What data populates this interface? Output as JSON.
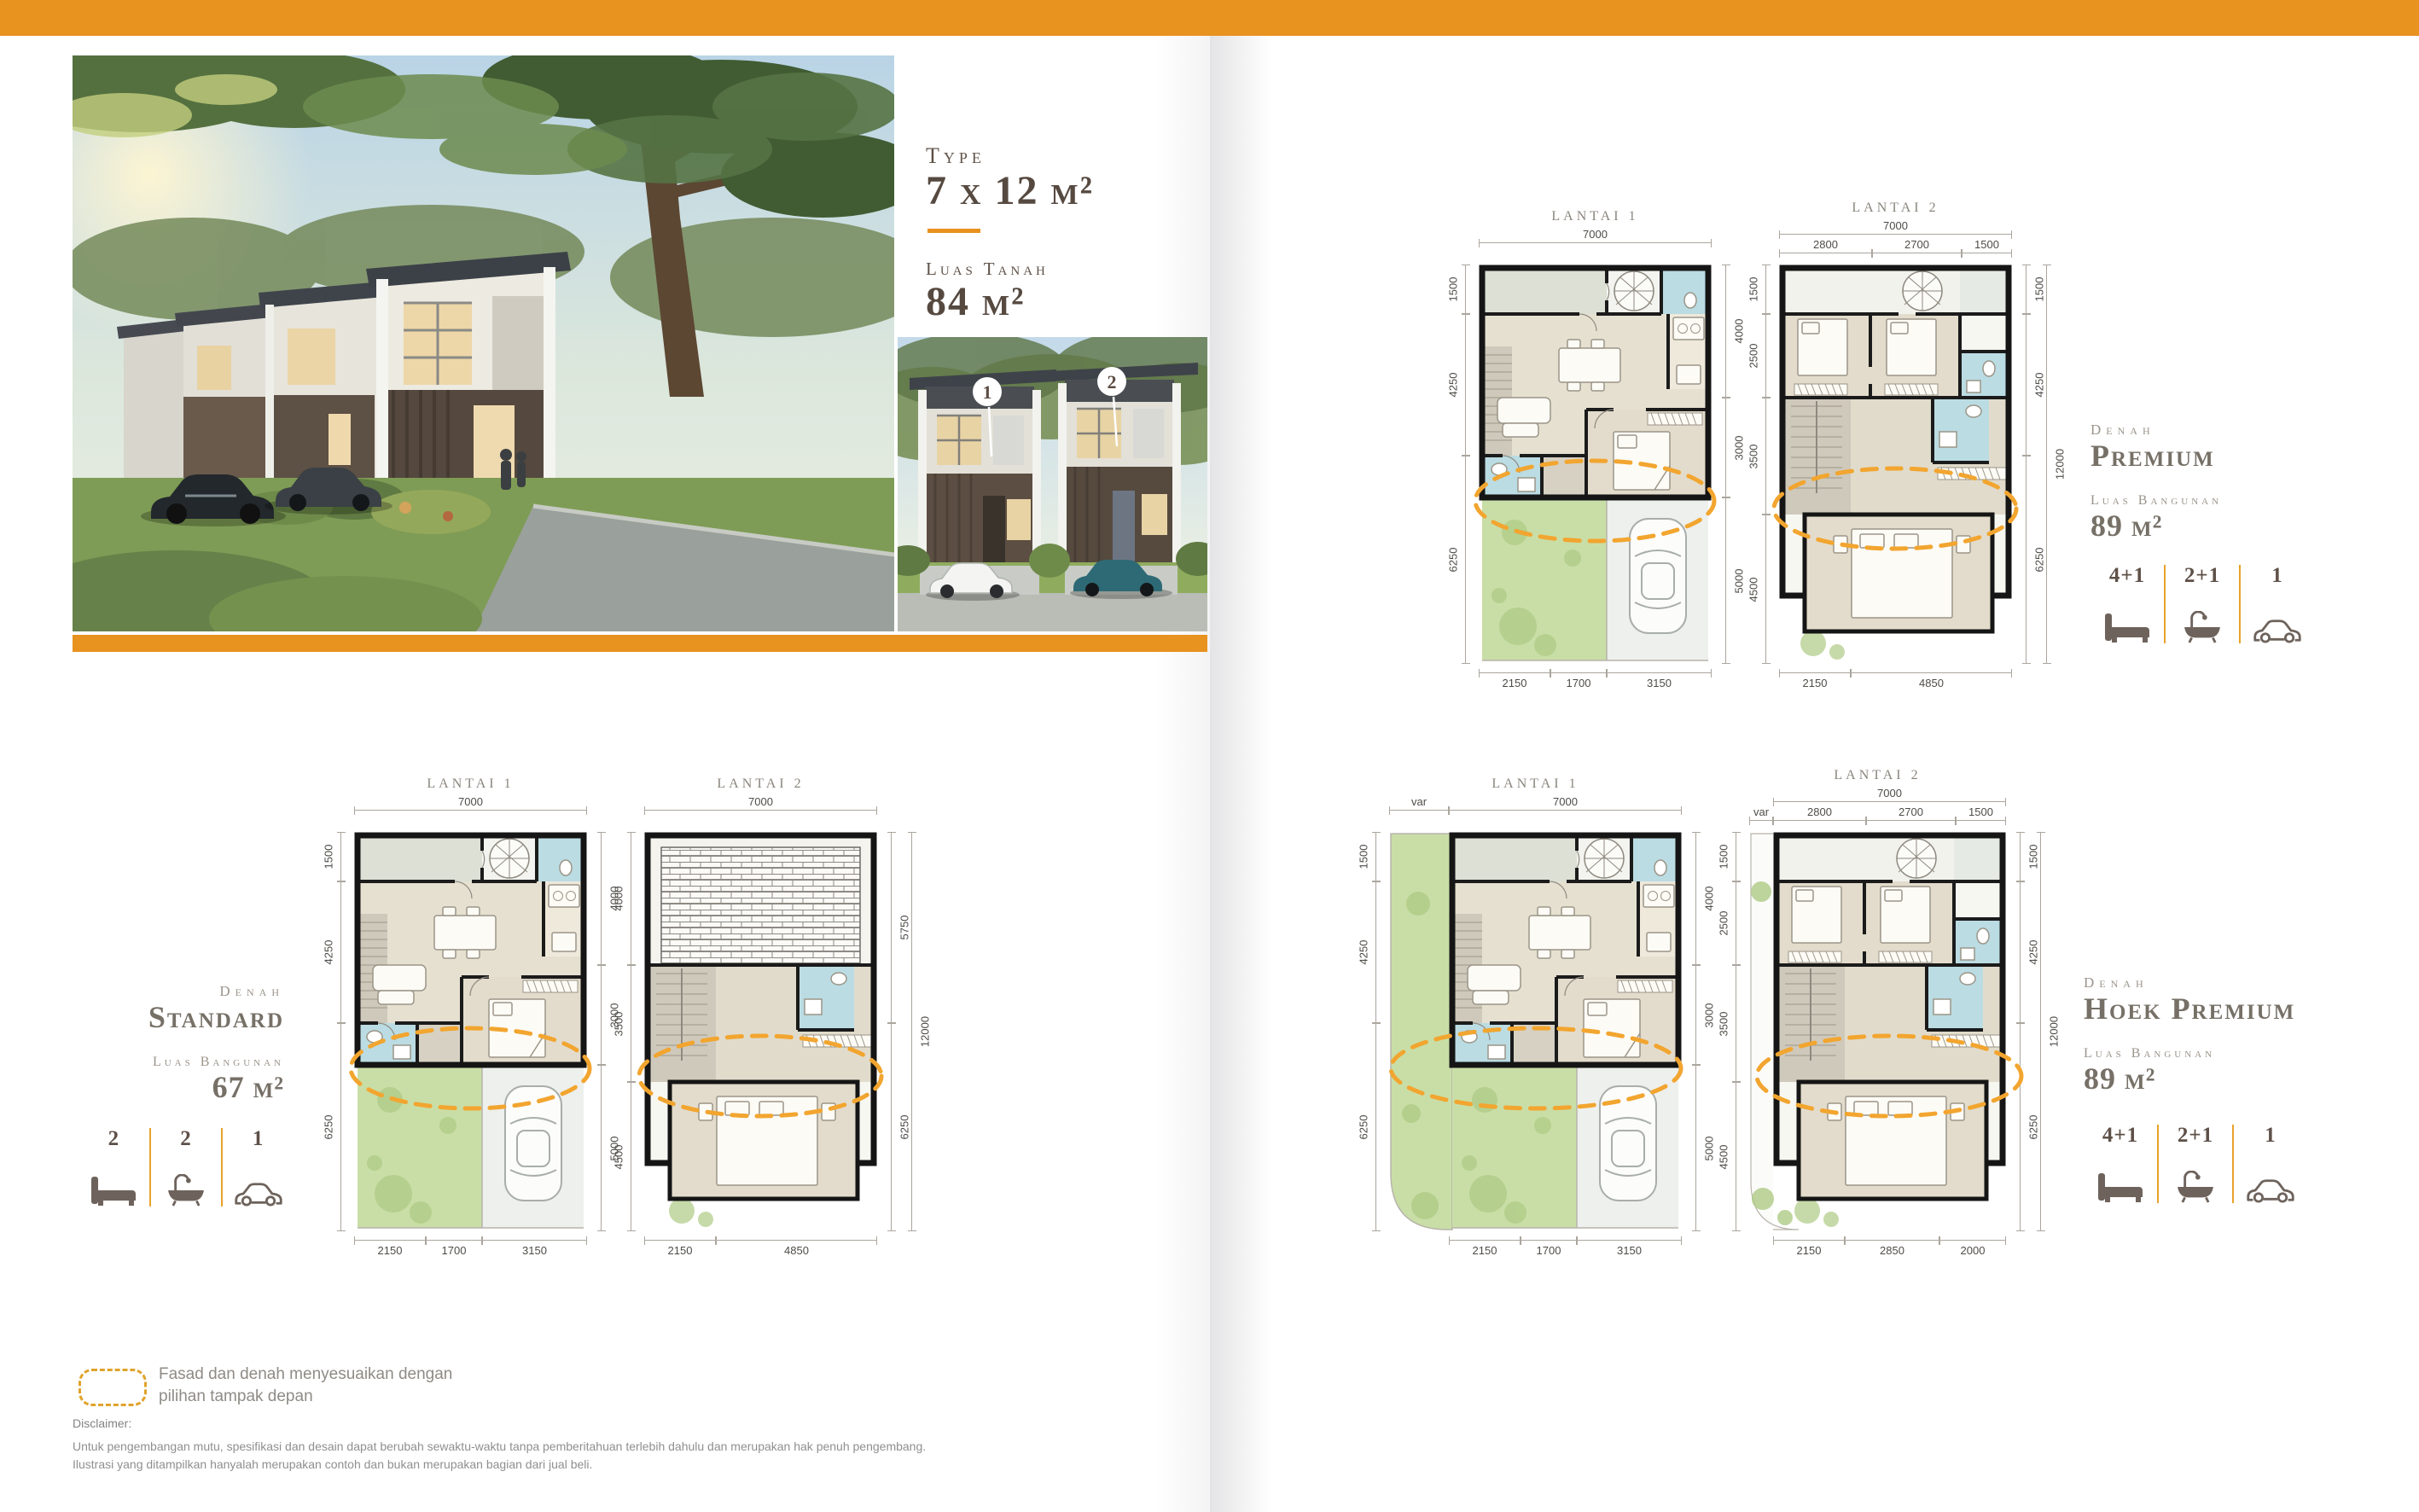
{
  "colors": {
    "accent": "#E8921F",
    "dashed_line": "#F2A52F",
    "ink": "#564940",
    "muted": "#9B948B"
  },
  "title_block": {
    "kicker": "Type",
    "type": "7 x 12 m²",
    "land_label": "Luas Tanah",
    "land_value": "84 m²"
  },
  "photo": {
    "marker1": "1",
    "marker2": "2"
  },
  "variants": {
    "standard": {
      "kicker": "Denah",
      "name": "Standard",
      "area_label": "Luas Bangunan",
      "area_value": "67 m²",
      "beds": "2",
      "baths": "2",
      "cars": "1"
    },
    "premium": {
      "kicker": "Denah",
      "name": "Premium",
      "area_label": "Luas Bangunan",
      "area_value": "89 m²",
      "beds": "4+1",
      "baths": "2+1",
      "cars": "1"
    },
    "hoek": {
      "kicker": "Denah",
      "name": "Hoek Premium",
      "area_label": "Luas Bangunan",
      "area_value": "89 m²",
      "beds": "4+1",
      "baths": "2+1",
      "cars": "1"
    }
  },
  "plans": {
    "std_l1": {
      "label": "Lantai 1",
      "top": [
        "7000"
      ],
      "left": [
        "1500",
        "4250",
        "6250"
      ],
      "right": [
        "4000",
        "3000",
        "5000"
      ],
      "bottom": [
        "2150",
        "1700",
        "3150"
      ]
    },
    "std_l2": {
      "label": "Lantai 2",
      "top": [
        "7000"
      ],
      "left": [
        "4000",
        "3500",
        "4500"
      ],
      "right": [
        "5750",
        "6250",
        "12000"
      ],
      "bottom": [
        "2150",
        "4850"
      ]
    },
    "prm_l1": {
      "label": "Lantai 1",
      "top": [
        "7000"
      ],
      "left": [
        "1500",
        "4250",
        "6250"
      ],
      "right": [
        "4000",
        "3000",
        "5000"
      ],
      "bottom": [
        "2150",
        "1700",
        "3150"
      ]
    },
    "prm_l2": {
      "label": "Lantai 2",
      "top": [
        "7000"
      ],
      "top_sub": [
        "2800",
        "2700",
        "1500"
      ],
      "left": [
        "1500",
        "2500",
        "3500",
        "4500"
      ],
      "right": [
        "1500",
        "4250",
        "6250",
        "12000"
      ],
      "bottom": [
        "2150",
        "4850"
      ]
    },
    "hoek_l1": {
      "label": "Lantai 1",
      "top": [
        "var",
        "7000"
      ],
      "left": [
        "1500",
        "4250",
        "6250"
      ],
      "right": [
        "4000",
        "3000",
        "5000"
      ],
      "bottom": [
        "2150",
        "1700",
        "3150"
      ]
    },
    "hoek_l2": {
      "label": "Lantai 2",
      "top": [
        "7000"
      ],
      "top_sub": [
        "var",
        "2800",
        "2700",
        "1500"
      ],
      "left": [
        "1500",
        "2500",
        "3500",
        "4500"
      ],
      "right": [
        "1500",
        "4250",
        "6250",
        "12000"
      ],
      "bottom": [
        "2150",
        "2850",
        "2000"
      ]
    }
  },
  "legend": {
    "line1": "Fasad dan denah menyesuaikan dengan",
    "line2": "pilihan tampak depan"
  },
  "disclaimer": {
    "title": "Disclaimer:",
    "line1": "Untuk pengembangan mutu, spesifikasi dan desain dapat berubah sewaktu-waktu tanpa pemberitahuan terlebih dahulu dan merupakan hak penuh pengembang.",
    "line2": "Ilustrasi yang ditampilkan hanyalah merupakan contoh dan bukan merupakan bagian dari jual beli."
  }
}
